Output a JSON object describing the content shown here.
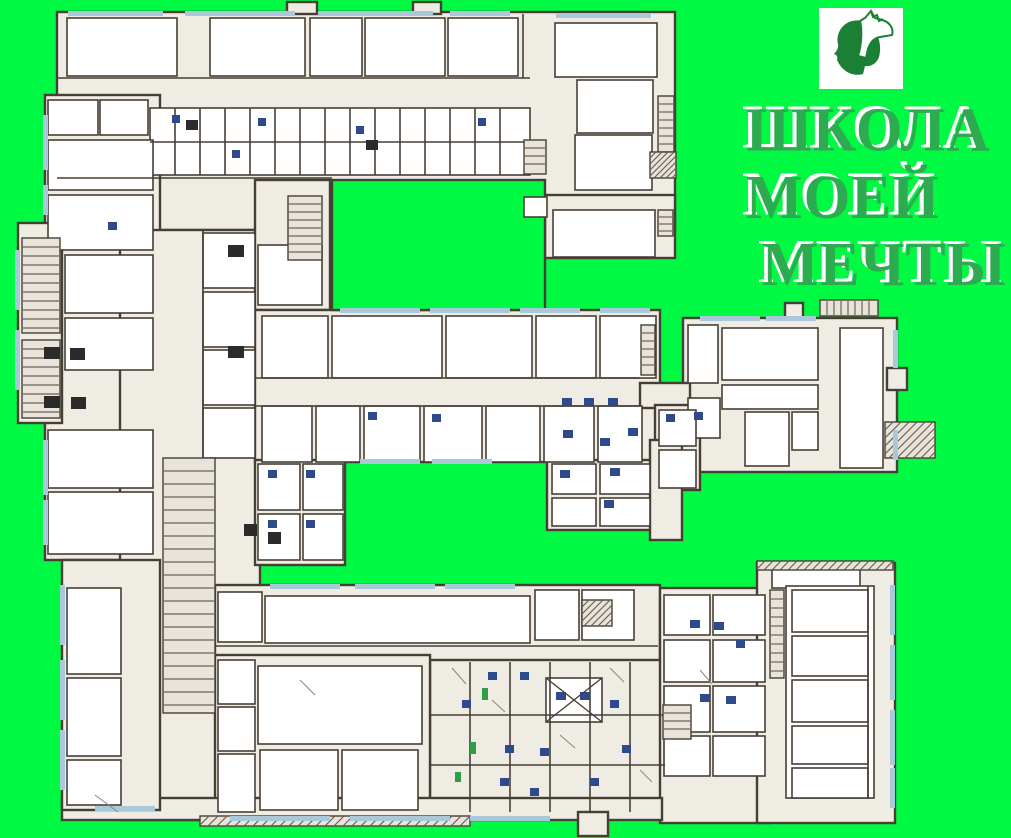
{
  "poster": {
    "background": "#00F943",
    "title": {
      "line1": "ШКОЛА",
      "line2": "МОЕЙ",
      "line3": "МЕЧТЫ",
      "color": "#2cab51",
      "highlight": "#ffffff"
    },
    "logo_icon": "man-and-horse",
    "logo_color": "#1b7f35"
  },
  "plan": {
    "colors": {
      "wall": "#473f35",
      "block": "#efece4",
      "room": "#ffffff",
      "window": "#a9c9da",
      "fixture": "#2e4a8c",
      "dark": "#2b2b2b",
      "door": "#2f9e44",
      "hatch": "#6b6257",
      "courtyard": "#00F943"
    },
    "blocks": [
      [
        57,
        12,
        618,
        218
      ],
      [
        545,
        195,
        130,
        63
      ],
      [
        45,
        95,
        115,
        465
      ],
      [
        18,
        223,
        44,
        200
      ],
      [
        120,
        230,
        140,
        590
      ],
      [
        255,
        180,
        75,
        130
      ],
      [
        255,
        310,
        405,
        152
      ],
      [
        683,
        318,
        214,
        154
      ],
      [
        640,
        383,
        50,
        25
      ],
      [
        655,
        405,
        45,
        85
      ],
      [
        255,
        460,
        90,
        105
      ],
      [
        547,
        460,
        108,
        70
      ],
      [
        650,
        440,
        32,
        100
      ],
      [
        215,
        585,
        445,
        80
      ],
      [
        430,
        660,
        235,
        155
      ],
      [
        215,
        655,
        215,
        160
      ],
      [
        660,
        588,
        110,
        235
      ],
      [
        757,
        563,
        138,
        260
      ],
      [
        62,
        798,
        600,
        22
      ],
      [
        62,
        560,
        98,
        250
      ],
      [
        287,
        2,
        30,
        12
      ],
      [
        413,
        2,
        28,
        12
      ],
      [
        785,
        303,
        18,
        15
      ],
      [
        887,
        368,
        20,
        22
      ],
      [
        578,
        812,
        30,
        24
      ]
    ],
    "courtyards": [
      [
        332,
        180,
        213,
        130
      ]
    ],
    "rooms": [
      [
        67,
        18,
        110,
        58
      ],
      [
        210,
        18,
        95,
        58
      ],
      [
        310,
        18,
        52,
        58
      ],
      [
        365,
        18,
        80,
        58
      ],
      [
        448,
        18,
        70,
        58
      ],
      [
        555,
        23,
        102,
        54
      ],
      [
        577,
        80,
        76,
        53
      ],
      [
        575,
        135,
        77,
        55
      ],
      [
        553,
        210,
        102,
        47
      ],
      [
        524,
        197,
        23,
        20
      ],
      [
        150,
        108,
        380,
        67
      ],
      [
        48,
        100,
        50,
        35
      ],
      [
        100,
        100,
        48,
        35
      ],
      [
        48,
        140,
        105,
        50
      ],
      [
        48,
        195,
        105,
        55
      ],
      [
        65,
        255,
        88,
        58
      ],
      [
        65,
        318,
        88,
        52
      ],
      [
        48,
        430,
        105,
        58
      ],
      [
        48,
        492,
        105,
        62
      ],
      [
        203,
        233,
        52,
        55
      ],
      [
        203,
        292,
        52,
        55
      ],
      [
        203,
        350,
        52,
        55
      ],
      [
        203,
        408,
        52,
        50
      ],
      [
        258,
        245,
        64,
        60
      ],
      [
        262,
        316,
        66,
        62
      ],
      [
        332,
        316,
        110,
        62
      ],
      [
        446,
        316,
        86,
        62
      ],
      [
        536,
        316,
        60,
        62
      ],
      [
        600,
        316,
        56,
        62
      ],
      [
        262,
        406,
        50,
        56
      ],
      [
        316,
        406,
        44,
        56
      ],
      [
        364,
        406,
        56,
        56
      ],
      [
        424,
        406,
        58,
        56
      ],
      [
        486,
        406,
        54,
        56
      ],
      [
        544,
        406,
        50,
        56
      ],
      [
        598,
        406,
        44,
        56
      ],
      [
        840,
        328,
        43,
        140
      ],
      [
        688,
        325,
        30,
        58
      ],
      [
        722,
        328,
        96,
        52
      ],
      [
        722,
        385,
        96,
        24
      ],
      [
        745,
        412,
        44,
        54
      ],
      [
        792,
        412,
        26,
        38
      ],
      [
        688,
        398,
        32,
        40
      ],
      [
        659,
        410,
        37,
        36
      ],
      [
        659,
        450,
        37,
        38
      ],
      [
        552,
        464,
        44,
        30
      ],
      [
        600,
        464,
        50,
        30
      ],
      [
        552,
        498,
        44,
        28
      ],
      [
        600,
        498,
        50,
        28
      ],
      [
        258,
        464,
        42,
        46
      ],
      [
        303,
        464,
        40,
        46
      ],
      [
        258,
        514,
        42,
        46
      ],
      [
        303,
        514,
        40,
        46
      ],
      [
        218,
        592,
        44,
        50
      ],
      [
        265,
        596,
        265,
        47
      ],
      [
        535,
        590,
        44,
        50
      ],
      [
        582,
        590,
        52,
        50
      ],
      [
        67,
        588,
        54,
        86
      ],
      [
        67,
        678,
        54,
        78
      ],
      [
        67,
        760,
        54,
        45
      ],
      [
        258,
        666,
        164,
        78
      ],
      [
        218,
        660,
        37,
        44
      ],
      [
        218,
        707,
        37,
        44
      ],
      [
        218,
        754,
        37,
        58
      ],
      [
        260,
        750,
        78,
        60
      ],
      [
        342,
        750,
        76,
        60
      ],
      [
        664,
        595,
        46,
        40
      ],
      [
        713,
        595,
        52,
        40
      ],
      [
        664,
        640,
        46,
        42
      ],
      [
        713,
        640,
        52,
        42
      ],
      [
        664,
        686,
        46,
        46
      ],
      [
        713,
        686,
        52,
        46
      ],
      [
        664,
        736,
        46,
        40
      ],
      [
        713,
        736,
        52,
        40
      ],
      [
        772,
        568,
        88,
        20
      ],
      [
        786,
        586,
        88,
        212
      ],
      [
        792,
        590,
        76,
        42
      ],
      [
        792,
        636,
        76,
        40
      ],
      [
        792,
        680,
        76,
        42
      ],
      [
        792,
        726,
        76,
        38
      ],
      [
        792,
        768,
        76,
        30
      ],
      [
        546,
        678,
        56,
        44
      ]
    ],
    "walls": [
      [
        57,
        78,
        530,
        78
      ],
      [
        150,
        142,
        530,
        142
      ],
      [
        57,
        178,
        332,
        178
      ],
      [
        255,
        378,
        640,
        378
      ],
      [
        255,
        406,
        640,
        406
      ],
      [
        215,
        646,
        658,
        646
      ],
      [
        203,
        230,
        203,
        460
      ],
      [
        430,
        715,
        665,
        715
      ],
      [
        430,
        765,
        665,
        765
      ],
      [
        470,
        662,
        470,
        812
      ],
      [
        510,
        662,
        510,
        812
      ],
      [
        550,
        662,
        550,
        812
      ],
      [
        590,
        662,
        590,
        812
      ],
      [
        630,
        662,
        630,
        812
      ],
      [
        523,
        14,
        523,
        78
      ],
      [
        868,
        586,
        868,
        798
      ],
      [
        175,
        108,
        175,
        175
      ],
      [
        200,
        108,
        200,
        175
      ],
      [
        225,
        108,
        225,
        175
      ],
      [
        250,
        108,
        250,
        175
      ],
      [
        275,
        108,
        275,
        175
      ],
      [
        300,
        108,
        300,
        175
      ],
      [
        325,
        108,
        325,
        175
      ],
      [
        350,
        108,
        350,
        175
      ],
      [
        375,
        108,
        375,
        175
      ],
      [
        400,
        108,
        400,
        175
      ],
      [
        425,
        108,
        425,
        175
      ],
      [
        450,
        108,
        450,
        175
      ],
      [
        475,
        108,
        475,
        175
      ],
      [
        500,
        108,
        500,
        175
      ]
    ],
    "stairs": [
      [
        22,
        238,
        38,
        95,
        "h",
        9
      ],
      [
        22,
        340,
        38,
        78,
        "h",
        9
      ],
      [
        288,
        196,
        34,
        64,
        "h",
        8
      ],
      [
        163,
        458,
        52,
        255,
        "h",
        13
      ],
      [
        524,
        140,
        22,
        34,
        "h",
        8
      ],
      [
        658,
        96,
        16,
        56,
        "h",
        8
      ],
      [
        658,
        210,
        15,
        26,
        "h",
        7
      ],
      [
        820,
        300,
        58,
        16,
        "v",
        7
      ],
      [
        641,
        325,
        14,
        50,
        "h",
        8
      ],
      [
        885,
        422,
        50,
        36,
        "d",
        8
      ],
      [
        650,
        152,
        26,
        26,
        "d",
        6
      ],
      [
        663,
        705,
        28,
        34,
        "h",
        8
      ],
      [
        582,
        600,
        30,
        26,
        "d",
        7
      ],
      [
        770,
        590,
        14,
        88,
        "h",
        9
      ],
      [
        200,
        816,
        270,
        10,
        "d",
        9
      ],
      [
        757,
        561,
        136,
        9,
        "d",
        8
      ]
    ],
    "windows": [
      [
        68,
        11,
        95,
        5
      ],
      [
        185,
        11,
        110,
        5
      ],
      [
        318,
        11,
        115,
        5
      ],
      [
        450,
        11,
        60,
        5
      ],
      [
        556,
        13,
        95,
        5
      ],
      [
        43,
        115,
        5,
        55
      ],
      [
        43,
        185,
        5,
        30
      ],
      [
        15,
        250,
        5,
        60
      ],
      [
        15,
        330,
        5,
        60
      ],
      [
        43,
        440,
        5,
        55
      ],
      [
        43,
        500,
        5,
        45
      ],
      [
        60,
        585,
        5,
        60
      ],
      [
        60,
        660,
        5,
        60
      ],
      [
        60,
        730,
        5,
        60
      ],
      [
        230,
        816,
        100,
        5
      ],
      [
        350,
        816,
        100,
        5
      ],
      [
        470,
        816,
        80,
        5
      ],
      [
        95,
        806,
        60,
        5
      ],
      [
        890,
        585,
        5,
        50
      ],
      [
        890,
        645,
        5,
        55
      ],
      [
        890,
        710,
        5,
        55
      ],
      [
        890,
        768,
        5,
        40
      ],
      [
        893,
        330,
        5,
        38
      ],
      [
        893,
        430,
        5,
        30
      ],
      [
        700,
        316,
        60,
        5
      ],
      [
        766,
        316,
        50,
        5
      ],
      [
        340,
        308,
        80,
        5
      ],
      [
        430,
        308,
        80,
        5
      ],
      [
        520,
        308,
        60,
        5
      ],
      [
        600,
        308,
        50,
        5
      ],
      [
        360,
        459,
        60,
        5
      ],
      [
        432,
        459,
        60,
        5
      ],
      [
        270,
        584,
        70,
        5
      ],
      [
        355,
        584,
        80,
        5
      ],
      [
        445,
        584,
        70,
        5
      ]
    ],
    "fixtures": [
      [
        172,
        115,
        8,
        8
      ],
      [
        232,
        150,
        8,
        8
      ],
      [
        356,
        126,
        8,
        8
      ],
      [
        478,
        118,
        8,
        8
      ],
      [
        258,
        118,
        8,
        8
      ],
      [
        562,
        398,
        10,
        8
      ],
      [
        584,
        398,
        10,
        8
      ],
      [
        608,
        398,
        10,
        8
      ],
      [
        563,
        430,
        10,
        8
      ],
      [
        600,
        438,
        10,
        8
      ],
      [
        628,
        428,
        10,
        8
      ],
      [
        368,
        412,
        9,
        8
      ],
      [
        432,
        414,
        9,
        8
      ],
      [
        560,
        470,
        10,
        8
      ],
      [
        610,
        468,
        10,
        8
      ],
      [
        604,
        500,
        10,
        8
      ],
      [
        268,
        470,
        9,
        8
      ],
      [
        306,
        470,
        9,
        8
      ],
      [
        268,
        520,
        9,
        8
      ],
      [
        306,
        520,
        9,
        8
      ],
      [
        488,
        672,
        9,
        8
      ],
      [
        520,
        672,
        9,
        8
      ],
      [
        556,
        692,
        10,
        8
      ],
      [
        580,
        692,
        10,
        8
      ],
      [
        462,
        700,
        9,
        8
      ],
      [
        505,
        745,
        9,
        8
      ],
      [
        540,
        748,
        9,
        8
      ],
      [
        500,
        778,
        9,
        8
      ],
      [
        530,
        788,
        9,
        8
      ],
      [
        610,
        700,
        9,
        8
      ],
      [
        622,
        745,
        9,
        8
      ],
      [
        590,
        778,
        9,
        8
      ],
      [
        690,
        620,
        10,
        8
      ],
      [
        714,
        622,
        10,
        8
      ],
      [
        700,
        694,
        10,
        8
      ],
      [
        726,
        696,
        10,
        8
      ],
      [
        736,
        640,
        9,
        8
      ],
      [
        666,
        414,
        9,
        8
      ],
      [
        694,
        412,
        9,
        8
      ],
      [
        108,
        222,
        9,
        8
      ]
    ],
    "darks": [
      [
        44,
        347,
        16,
        12
      ],
      [
        70,
        348,
        15,
        12
      ],
      [
        44,
        396,
        16,
        12
      ],
      [
        71,
        397,
        15,
        12
      ],
      [
        228,
        245,
        16,
        12
      ],
      [
        228,
        346,
        16,
        12
      ],
      [
        244,
        524,
        13,
        12
      ],
      [
        268,
        532,
        13,
        12
      ],
      [
        186,
        120,
        12,
        10
      ],
      [
        366,
        140,
        12,
        10
      ]
    ],
    "doors": [
      [
        482,
        688,
        6,
        12
      ],
      [
        470,
        742,
        6,
        12
      ],
      [
        455,
        772,
        6,
        10
      ]
    ],
    "diagonals": [
      [
        452,
        668,
        466,
        684
      ],
      [
        492,
        700,
        505,
        712
      ],
      [
        560,
        735,
        575,
        748
      ],
      [
        610,
        668,
        624,
        682
      ],
      [
        300,
        680,
        315,
        695
      ],
      [
        95,
        795,
        118,
        812
      ],
      [
        640,
        770,
        652,
        782
      ],
      [
        700,
        670,
        712,
        684
      ]
    ],
    "xmarks": [
      [
        546,
        678,
        56,
        44
      ]
    ]
  }
}
